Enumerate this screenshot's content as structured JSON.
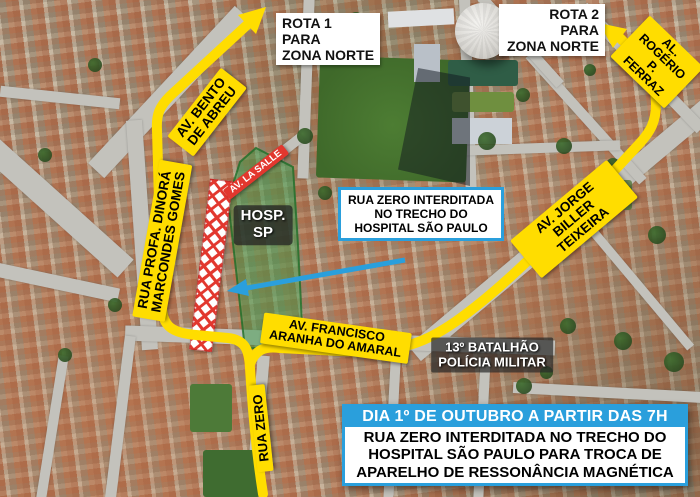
{
  "colors": {
    "route_yellow": "#ffdd00",
    "accent_blue": "#2a9fdc",
    "alert_red": "#e2372e",
    "zone_green": "#3e9a4a"
  },
  "signs": {
    "rota1": "ROTA 1\nPARA\nZONA NORTE",
    "rota2": "ROTA 2\nPARA\nZONA NORTE"
  },
  "streets": {
    "av_bento": "AV. BENTO\nDE ABREU",
    "rua_profa": "RUA PROFA. DINORÁ\nMARCONDES GOMES",
    "av_la_salle": "AV. LA SALLE",
    "av_jorge": "AV. JORGE\nBILLER TEIXEIRA",
    "al_rogerio": "AL. ROGÉRIO\nP. FERRAZ",
    "av_francisco": "AV. FRANCISCO\nARANHA DO AMARAL",
    "rua_zero": "RUA ZERO"
  },
  "landmarks": {
    "hospital": "HOSP.\nSP",
    "battalion": "13º BATALHÃO\nPOLÍCIA MILITAR"
  },
  "callout": {
    "text": "RUA ZERO INTERDITADA\nNO TRECHO DO\nHOSPITAL SÃO PAULO"
  },
  "banner": {
    "header": "DIA 1º DE OUTUBRO A PARTIR DAS 7H",
    "body": "RUA ZERO INTERDITADA NO TRECHO DO\nHOSPITAL SÃO PAULO PARA TROCA DE\nAPARELHO DE RESSONÂNCIA MAGNÉTICA"
  }
}
